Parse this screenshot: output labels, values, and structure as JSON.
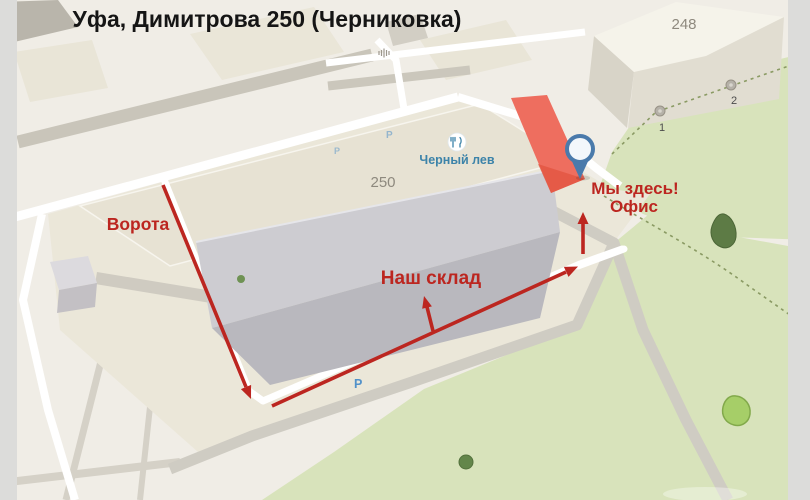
{
  "title": "Уфа, Димитрова 250 (Черниковка)",
  "annotations": {
    "gates": "Ворота",
    "warehouse": "Наш склад",
    "here_line1": "Мы здесь!",
    "here_line2": "Офис"
  },
  "buildings": {
    "plot_number": "250",
    "neighbor_number": "248"
  },
  "poi": {
    "name": "Черный лев"
  },
  "entrance_markers": [
    "1",
    "2"
  ],
  "parking_label": "P",
  "colors": {
    "accent_red": "#bc2620",
    "section_salmon": "#ee6e5f",
    "section_salmon_dark": "#e2543f",
    "grass": "#d8e3bb",
    "road_white": "#ffffff",
    "road_gray": "#cfccc3",
    "road_gray_minor": "#d5d1c7",
    "pin_blue": "#4a7aab",
    "poi_blue": "#3c83a9",
    "parking_blue": "#5191c9"
  }
}
